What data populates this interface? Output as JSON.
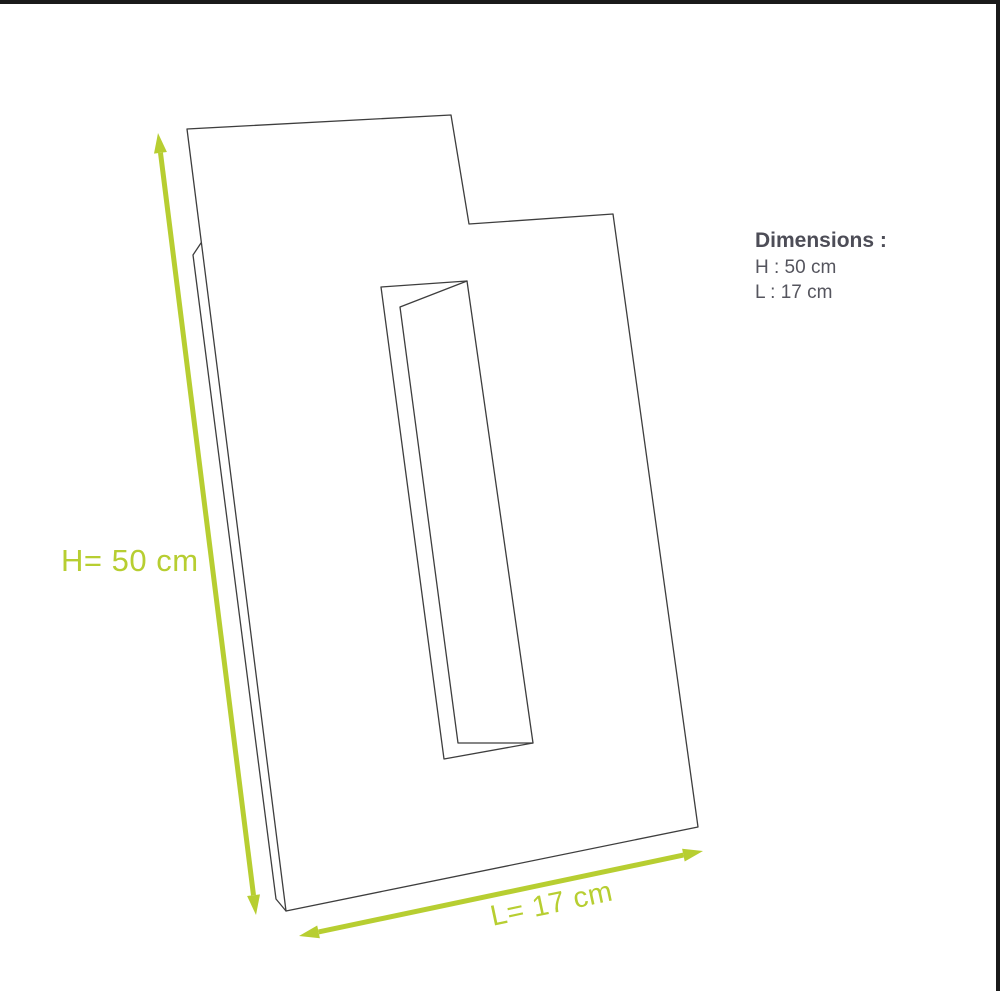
{
  "diagram": {
    "height_dimension_label": "H= 50 cm",
    "length_dimension_label": "L= 17 cm"
  },
  "info_panel": {
    "title": "Dimensions :",
    "lines": [
      "H : 50 cm",
      "L : 17 cm"
    ]
  },
  "icons": {
    "height_arrow": "double-headed-vertical-dimension-arrow",
    "length_arrow": "double-headed-diagonal-dimension-arrow"
  },
  "colors": {
    "page_background": "#ffffff",
    "accent_green": "#b7ce31",
    "outline_gray": "#3e3e3e",
    "title_text": "#4d4d57",
    "body_text": "#55555e",
    "frame_border": "#1a1a1a"
  }
}
